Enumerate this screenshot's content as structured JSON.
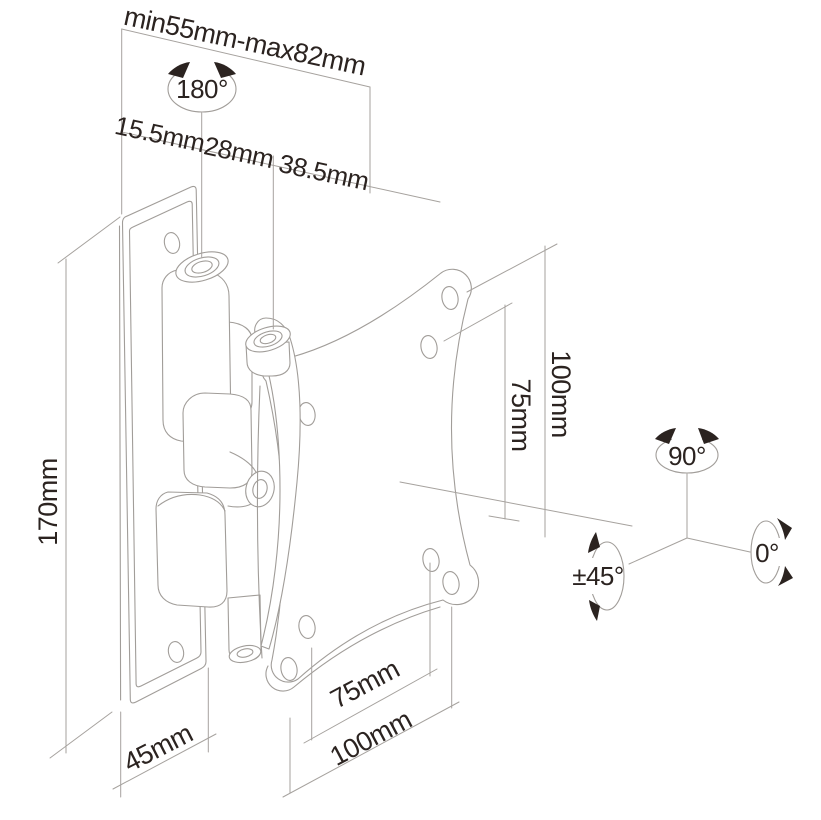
{
  "figure": {
    "kind": "technical line drawing",
    "subject": "tilt-and-swivel monitor wall mount bracket",
    "colors": {
      "background": "#ffffff",
      "line": "#a19d99",
      "text": "#2b2320"
    }
  },
  "labels": {
    "top_range": "min55mm-max82mm",
    "swivel_180": "180°",
    "seg_1": "15.5mm",
    "seg_2": "28mm",
    "seg_3": "38.5mm",
    "height_170": "170mm",
    "vesa_v_100": "100mm",
    "vesa_v_75": "75mm",
    "depth_45": "45mm",
    "vesa_h_75": "75mm",
    "vesa_h_100": "100mm",
    "tilt_90": "90°",
    "tilt_0": "0°",
    "swivel_45": "±45°"
  }
}
